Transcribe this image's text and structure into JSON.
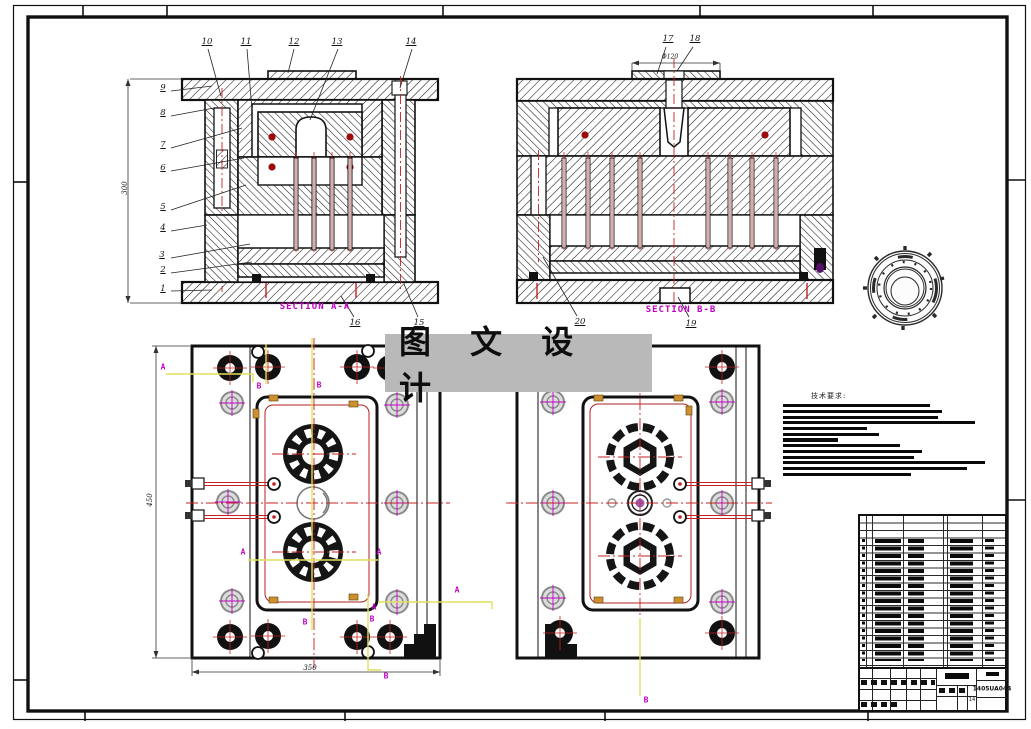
{
  "watermark": {
    "text": "图 文 设 计"
  },
  "views": {
    "section_a_label": "SECTION A-A",
    "section_b_label": "SECTION B-B"
  },
  "part_numbers": {
    "n1": "1",
    "n2": "2",
    "n3": "3",
    "n4": "4",
    "n5": "5",
    "n6": "6",
    "n7": "7",
    "n8": "8",
    "n9": "9",
    "n10": "10",
    "n11": "11",
    "n12": "12",
    "n13": "13",
    "n14": "14",
    "n15": "15",
    "n16": "16",
    "n17": "17",
    "n18": "18",
    "n19": "19",
    "n20": "20"
  },
  "dimensions": {
    "plan_width": "350",
    "plan_height": "450",
    "section_height": "300",
    "ring_dia": "Φ120"
  },
  "section_markers": {
    "a": "A",
    "b": "B"
  },
  "tech_notes": {
    "title": "技术要求:"
  },
  "title_block": {
    "drawing_number": "1405UA044",
    "sheet_code": "14"
  },
  "colors": {
    "centerline_red": "#c42222",
    "section_label_magenta": "#c400c4",
    "cut_line_yellow": "#e6e65a",
    "watermark_gray": "#b9b9b9",
    "hatch_black": "#1a1a1a"
  }
}
